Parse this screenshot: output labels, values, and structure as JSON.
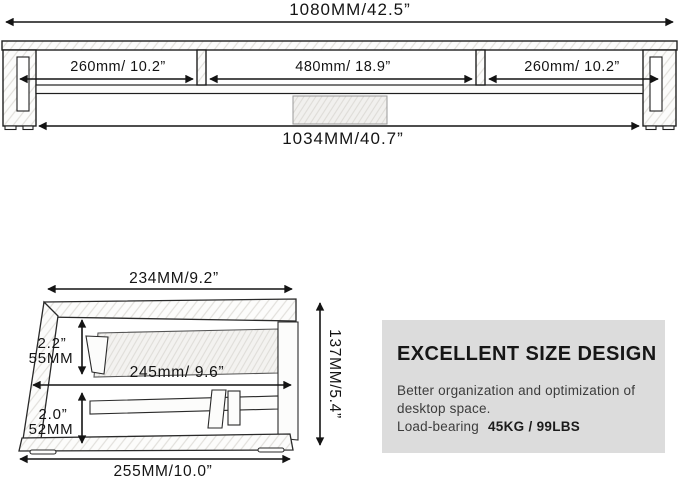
{
  "top_view": {
    "total_width_label": "1080MM/42.5”",
    "sections": [
      {
        "label": "260mm/ 10.2”"
      },
      {
        "label": "480mm/ 18.9”"
      },
      {
        "label": "260mm/ 10.2”"
      }
    ],
    "inner_width_label": "1034MM/40.7”"
  },
  "side_view": {
    "top_depth_label": "234MM/9.2”",
    "upper_gap_inch": "2.2”",
    "upper_gap_mm": "55MM",
    "middle_depth_label": "245mm/ 9.6”",
    "lower_gap_inch": "2.0”",
    "lower_gap_mm": "52MM",
    "bottom_depth_label": "255MM/10.0”",
    "height_label": "137MM/5.4”"
  },
  "info_box": {
    "title": "EXCELLENT SIZE DESIGN",
    "description_line1": "Better organization and optimization of",
    "description_line2": "desktop space.",
    "load_label": "Load-bearing",
    "load_value": "45KG / 99LBS"
  },
  "colors": {
    "background": "#ffffff",
    "line": "#141414",
    "info_box_background": "#dcdcdc",
    "wood_hatch": "#e2e0dc"
  }
}
